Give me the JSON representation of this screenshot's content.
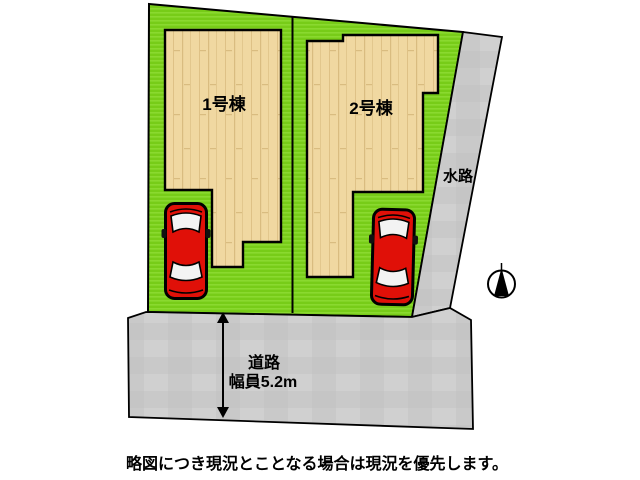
{
  "diagram": {
    "buildings": [
      {
        "label": "1号棟"
      },
      {
        "label": "2号棟"
      }
    ],
    "waterway_label": "水路",
    "road": {
      "name": "道路",
      "width": "幅員5.2m"
    },
    "caption": "略図につき現況とことなる場合は現況を優先します。"
  },
  "icons": {
    "compass": "north-compass-icon",
    "cars": "red-car-topview"
  },
  "colors": {
    "plot_green": "#77cc18",
    "plot_green_light": "#8ad92f",
    "building_fill": "#f0d8a1",
    "building_plank_line": "#d9bc80",
    "surface_gray": "#c9c9c9",
    "surface_gray_light": "#d4d4d4",
    "car_red": "#e01008",
    "outline": "#000000"
  }
}
